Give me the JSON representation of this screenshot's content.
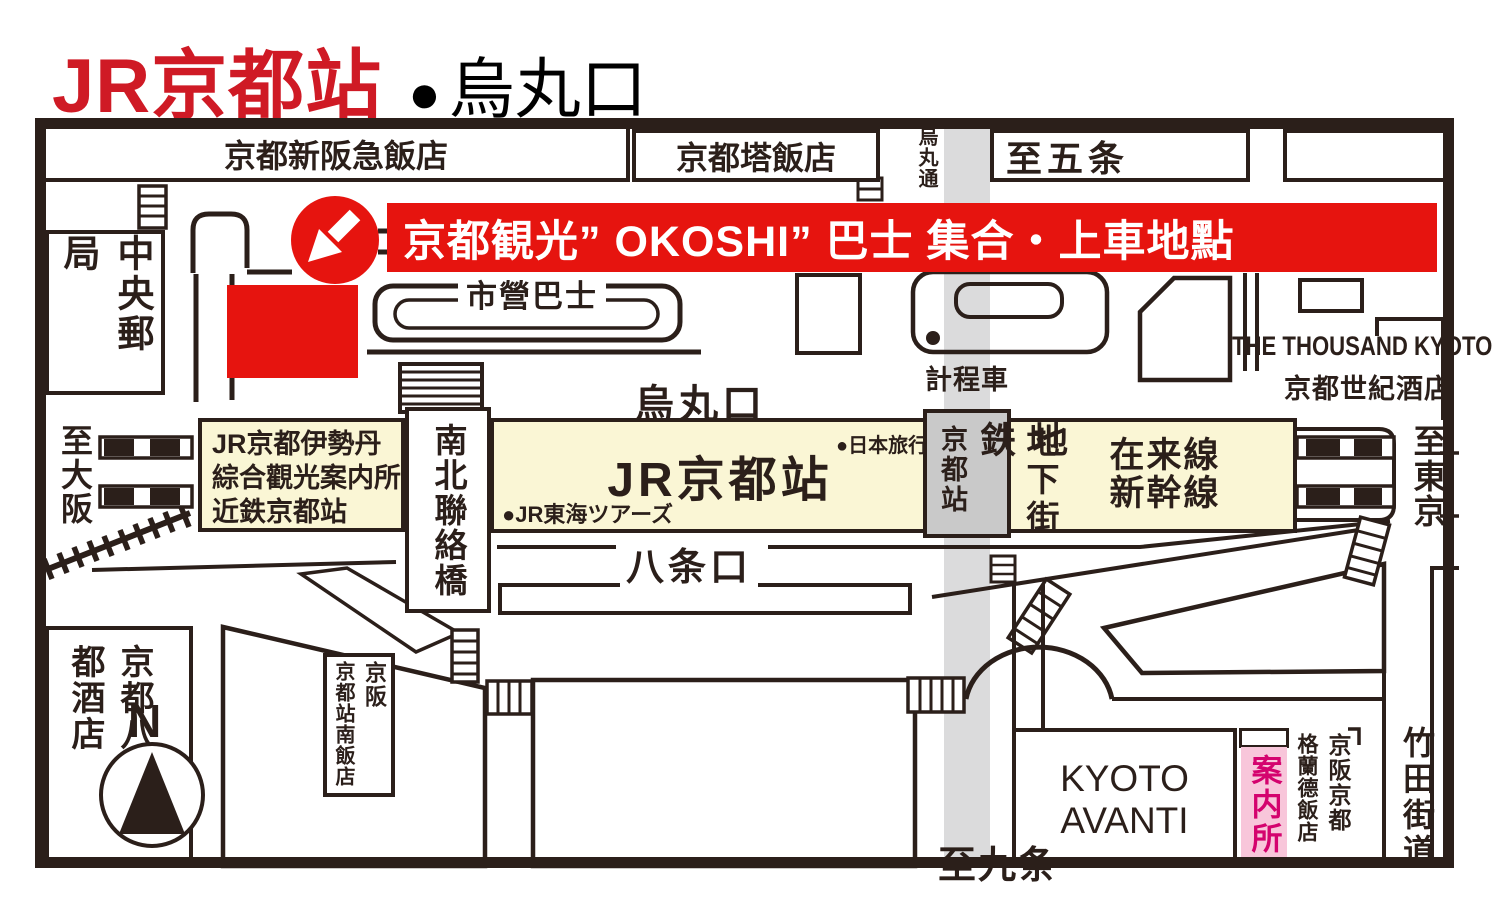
{
  "title": {
    "station": "JR京都站",
    "bullet": "●",
    "exit": "烏丸口"
  },
  "banner": {
    "text": "京都観光” OKOSHI” 巴士 集合・上車地點"
  },
  "north": {
    "hotel_shin_hankyu": "京都新阪急飯店",
    "hotel_tower": "京都塔飯店",
    "karasuma_dori": "烏丸通",
    "to_gojo": "至五条",
    "central_post_office": "中央郵局",
    "city_bus": "市營巴士",
    "karasuma_exit": "烏丸口",
    "taxi": "計程車",
    "thousand_kyoto_en": "THE THOUSAND KYOTO",
    "thousand_kyoto_zh": "京都世紀酒店"
  },
  "station": {
    "isetan_line1": "JR京都伊勢丹",
    "isetan_line2": "綜合觀光案内所",
    "isetan_line3": "近鉄京都站",
    "bridge": "南北聯絡橋",
    "jr_kyoto": "JR京都站",
    "jr_tokai_tours": "●JR東海ツアーズ",
    "nippon_travel": "●日本旅行",
    "subway_station": "京都站",
    "subway": "地鉄",
    "underground_mall": "地下街",
    "conventional_lines": "在来線",
    "shinkansen": "新幹線"
  },
  "directions": {
    "to_osaka": "至大阪",
    "to_tokyo": "至東京",
    "to_kujo": "至九条",
    "hachijo_exit": "八条口",
    "compass_north": "N"
  },
  "south": {
    "hachijo_miyako_hotel": "京都八條 都酒店",
    "keihan": "京阪",
    "kyoto_sta_south_hotel": "京都站南飯店",
    "kyoto_avanti_line1": "KYOTO",
    "kyoto_avanti_line2": "AVANTI",
    "info_center": "案内所",
    "keihan_kyoto": "京阪京都",
    "grande_hotel": "格蘭德飯店",
    "takeda_kaido": "竹田街道"
  },
  "colors": {
    "banner_red": "#E6140F",
    "title_red": "#CF1A25",
    "station_cream": "#FAF6D5",
    "street_gray": "#DBDBDC",
    "subway_gray": "#C9C9C9",
    "info_pink": "#F8C6DA",
    "info_magenta": "#D4036E",
    "line_ink": "#2B1F1A"
  }
}
